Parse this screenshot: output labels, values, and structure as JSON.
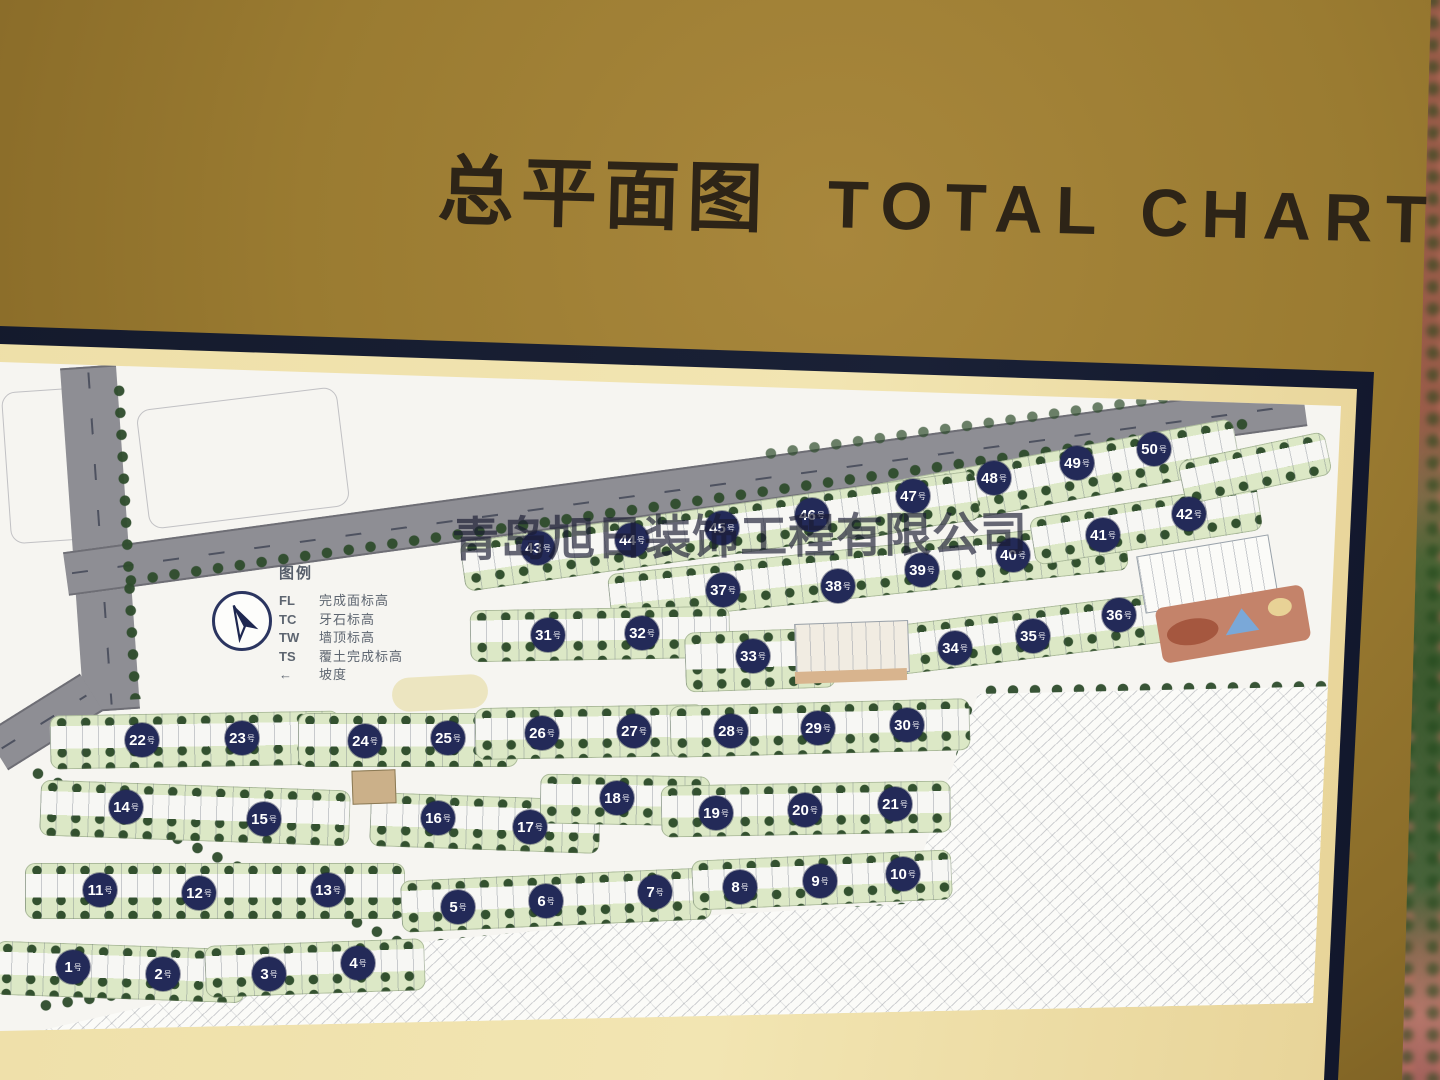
{
  "title": {
    "zh": "总平面图",
    "en": "TOTAL CHART"
  },
  "watermark": "青岛旭日装饰工程有限公司",
  "legend": {
    "title": "图例",
    "entries": [
      {
        "key": "FL",
        "label": "完成面标高"
      },
      {
        "key": "TC",
        "label": "牙石标高"
      },
      {
        "key": "TW",
        "label": "墙顶标高"
      },
      {
        "key": "TS",
        "label": "覆土完成标高"
      },
      {
        "key": "←",
        "label": "坡度",
        "icon": "slope-arrow"
      }
    ]
  },
  "map": {
    "building_suffix": "号",
    "buildings": [
      {
        "n": 1,
        "x": 73,
        "y": 967
      },
      {
        "n": 2,
        "x": 163,
        "y": 974
      },
      {
        "n": 3,
        "x": 269,
        "y": 974
      },
      {
        "n": 4,
        "x": 358,
        "y": 963
      },
      {
        "n": 5,
        "x": 458,
        "y": 907
      },
      {
        "n": 6,
        "x": 546,
        "y": 901
      },
      {
        "n": 7,
        "x": 655,
        "y": 892
      },
      {
        "n": 8,
        "x": 740,
        "y": 887
      },
      {
        "n": 9,
        "x": 820,
        "y": 881
      },
      {
        "n": 10,
        "x": 903,
        "y": 874
      },
      {
        "n": 11,
        "x": 100,
        "y": 890
      },
      {
        "n": 12,
        "x": 199,
        "y": 893
      },
      {
        "n": 13,
        "x": 328,
        "y": 890
      },
      {
        "n": 14,
        "x": 126,
        "y": 807
      },
      {
        "n": 15,
        "x": 264,
        "y": 819
      },
      {
        "n": 16,
        "x": 438,
        "y": 818
      },
      {
        "n": 17,
        "x": 530,
        "y": 827
      },
      {
        "n": 18,
        "x": 617,
        "y": 798
      },
      {
        "n": 19,
        "x": 716,
        "y": 813
      },
      {
        "n": 20,
        "x": 805,
        "y": 810
      },
      {
        "n": 21,
        "x": 895,
        "y": 804
      },
      {
        "n": 22,
        "x": 142,
        "y": 740
      },
      {
        "n": 23,
        "x": 242,
        "y": 738
      },
      {
        "n": 24,
        "x": 365,
        "y": 741
      },
      {
        "n": 25,
        "x": 448,
        "y": 738
      },
      {
        "n": 26,
        "x": 542,
        "y": 733
      },
      {
        "n": 27,
        "x": 634,
        "y": 731
      },
      {
        "n": 28,
        "x": 731,
        "y": 731
      },
      {
        "n": 29,
        "x": 818,
        "y": 728
      },
      {
        "n": 30,
        "x": 907,
        "y": 725
      },
      {
        "n": 31,
        "x": 548,
        "y": 635
      },
      {
        "n": 32,
        "x": 642,
        "y": 633
      },
      {
        "n": 33,
        "x": 753,
        "y": 656
      },
      {
        "n": 34,
        "x": 955,
        "y": 648
      },
      {
        "n": 35,
        "x": 1033,
        "y": 636
      },
      {
        "n": 36,
        "x": 1119,
        "y": 615
      },
      {
        "n": 37,
        "x": 723,
        "y": 590
      },
      {
        "n": 38,
        "x": 838,
        "y": 586
      },
      {
        "n": 39,
        "x": 922,
        "y": 570
      },
      {
        "n": 40,
        "x": 1013,
        "y": 555
      },
      {
        "n": 41,
        "x": 1103,
        "y": 535
      },
      {
        "n": 42,
        "x": 1189,
        "y": 514
      },
      {
        "n": 43,
        "x": 538,
        "y": 548
      },
      {
        "n": 44,
        "x": 632,
        "y": 540
      },
      {
        "n": 45,
        "x": 722,
        "y": 528
      },
      {
        "n": 46,
        "x": 812,
        "y": 515
      },
      {
        "n": 47,
        "x": 913,
        "y": 496
      },
      {
        "n": 48,
        "x": 994,
        "y": 478
      },
      {
        "n": 49,
        "x": 1077,
        "y": 463
      },
      {
        "n": 50,
        "x": 1154,
        "y": 449
      }
    ],
    "blocks": [
      {
        "x": 1040,
        "y": 480,
        "w": 400,
        "h": 52,
        "r": -10.5
      },
      {
        "x": 720,
        "y": 531,
        "w": 520,
        "h": 50,
        "r": -8
      },
      {
        "x": 868,
        "y": 572,
        "w": 520,
        "h": 50,
        "r": -6
      },
      {
        "x": 1146,
        "y": 524,
        "w": 230,
        "h": 48,
        "r": -9
      },
      {
        "x": 1255,
        "y": 468,
        "w": 150,
        "h": 44,
        "r": -12
      },
      {
        "x": 600,
        "y": 634,
        "w": 260,
        "h": 52,
        "r": -1
      },
      {
        "x": 760,
        "y": 660,
        "w": 150,
        "h": 60,
        "r": -2
      },
      {
        "x": 1037,
        "y": 633,
        "w": 300,
        "h": 50,
        "r": -7
      },
      {
        "x": 195,
        "y": 740,
        "w": 290,
        "h": 54,
        "r": -1
      },
      {
        "x": 408,
        "y": 740,
        "w": 220,
        "h": 54,
        "r": 0
      },
      {
        "x": 590,
        "y": 732,
        "w": 230,
        "h": 52,
        "r": -1
      },
      {
        "x": 820,
        "y": 728,
        "w": 300,
        "h": 52,
        "r": -1.5
      },
      {
        "x": 195,
        "y": 813,
        "w": 310,
        "h": 56,
        "r": 2
      },
      {
        "x": 485,
        "y": 823,
        "w": 230,
        "h": 54,
        "r": 2
      },
      {
        "x": 625,
        "y": 800,
        "w": 170,
        "h": 50,
        "r": 1
      },
      {
        "x": 806,
        "y": 809,
        "w": 290,
        "h": 52,
        "r": -1
      },
      {
        "x": 215,
        "y": 891,
        "w": 380,
        "h": 56,
        "r": 0
      },
      {
        "x": 556,
        "y": 900,
        "w": 310,
        "h": 52,
        "r": -2.5
      },
      {
        "x": 822,
        "y": 880,
        "w": 260,
        "h": 50,
        "r": -2.5
      },
      {
        "x": 120,
        "y": 972,
        "w": 250,
        "h": 54,
        "r": 2
      },
      {
        "x": 315,
        "y": 968,
        "w": 220,
        "h": 52,
        "r": -2
      }
    ]
  },
  "colors": {
    "board_gold": "#9a7b31",
    "frame_navy": "#161c2e",
    "mat_cream": "#eedfa8",
    "map_white": "#f6f5f1",
    "circle_navy": "#232a58",
    "road_gray": "#8e8e94",
    "tree_green": "#2e4c2c",
    "lawn_green": "#dce8c6",
    "playground_terracotta": "#c4836a",
    "pool_blue": "#7aa8d8"
  }
}
